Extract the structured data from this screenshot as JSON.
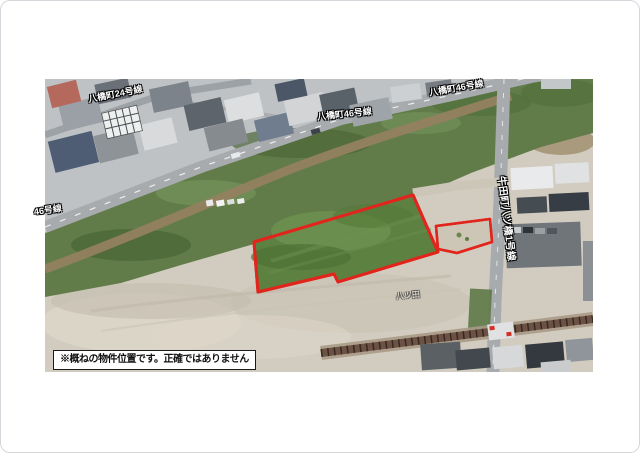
{
  "map": {
    "type": "aerial-photo-property-location",
    "labels": {
      "road_24": "八橋町24号線",
      "road_46_left": "46号線",
      "road_46_mid": "八橋町46号線",
      "road_46_right": "八橋町46号線",
      "road_vertical": "牛田町八ツ橋1号線",
      "area_faint": "八ツ田",
      "disclaimer": "※概ねの物件位置です。正確ではありません"
    },
    "colors": {
      "parcel_outline": "#e1251c",
      "parcel_fill": "#5d8140",
      "sub_parcel_fill": "#cdc5b6",
      "road_label_text": "#ffffff",
      "disclaimer_bg": "#ffffff",
      "disclaimer_border": "#1a1a1a",
      "disclaimer_text": "#111111"
    }
  }
}
